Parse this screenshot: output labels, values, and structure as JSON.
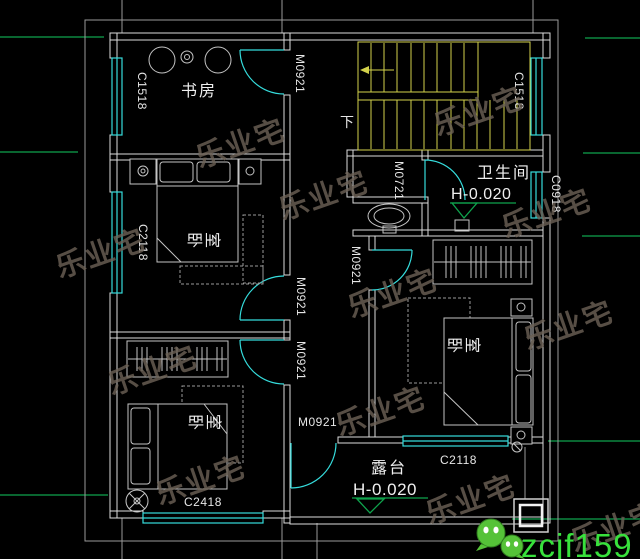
{
  "drawing": {
    "type": "floor-plan",
    "rooms": {
      "study": "书房",
      "bedroom": "卧室",
      "bathroom": "卫生间",
      "terrace": "露台"
    },
    "doors": {
      "m0921": "M0921",
      "m0721": "M0721"
    },
    "windows": {
      "c1518": "C1518",
      "c2118": "C2118",
      "c2418": "C2418",
      "c0918": "C0918"
    },
    "elevation": {
      "value": "H-0.020"
    },
    "stairs": {
      "down_label": "下"
    }
  },
  "watermark": {
    "text": "乐业宅"
  },
  "contact": {
    "wechat_id": "zcjf159"
  },
  "colors": {
    "background": "#000000",
    "walls": "#dcdcdc",
    "windows_cyan": "#35dcdc",
    "stairs_yellow": "#d3d24b",
    "axis_green": "#0fa34d",
    "watermark_gray": "#6d6257",
    "wechat_green": "#38e13c"
  }
}
